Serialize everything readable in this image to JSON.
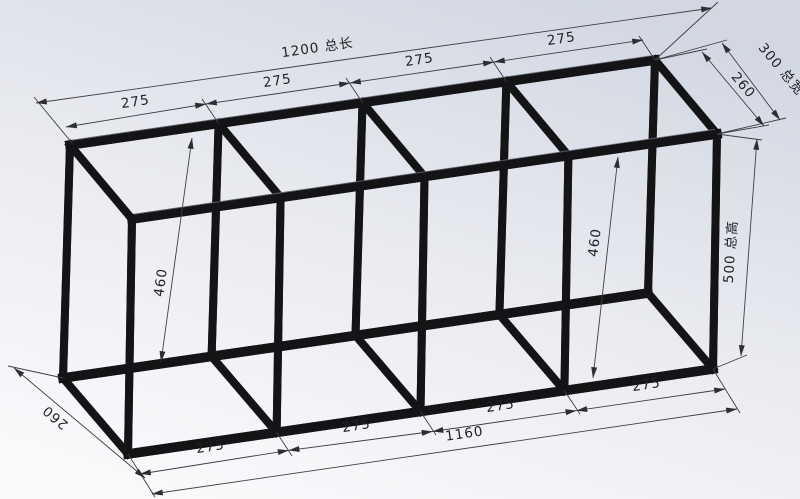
{
  "drawing": {
    "type": "cad-isometric-frame-drawing",
    "dimensions": {
      "total_length_label": "1200 总长",
      "total_width_label": "300 总宽",
      "total_height_label": "500 总高",
      "inner_length_label": "1160",
      "inner_width_top_label": "260",
      "inner_width_bottom_label": "260",
      "inner_height_left_label": "460",
      "inner_height_right_label": "460",
      "top_bay_labels": [
        "275",
        "275",
        "275",
        "275"
      ],
      "bottom_bay_labels": [
        "275",
        "275",
        "275",
        "275"
      ]
    },
    "colors": {
      "beam": "#141417",
      "beam_texture": "#45464c",
      "dimension_line": "#3f3f43",
      "dimension_text": "#222226",
      "background_top": "#d2d7e2",
      "background_bottom": "#f8f9fb"
    }
  }
}
